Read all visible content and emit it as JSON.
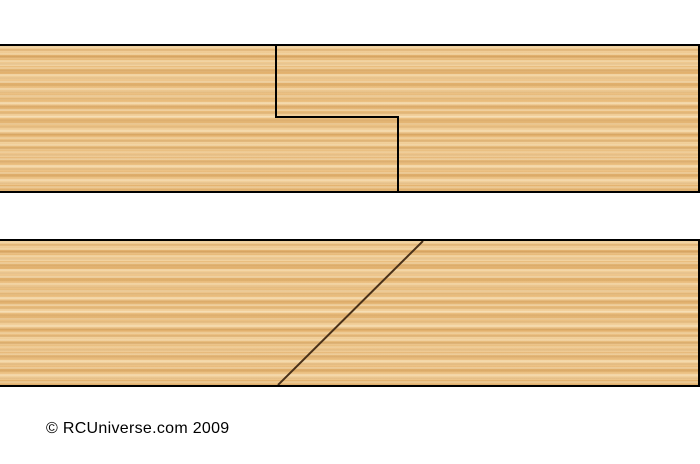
{
  "diagram": {
    "title_visible": false,
    "colors": {
      "background": "#ffffff",
      "wood_base": "#e9bc7e",
      "wood_grain_light": "#f4cd92",
      "wood_grain_dark": "#d9a763",
      "board_outline": "#000000",
      "half_lap_joint_line": "#000000",
      "scarf_joint_line": "#4a3119",
      "copyright_text_color": "#000000"
    }
  },
  "footer": {
    "copyright": "© RCUniverse.com 2009"
  }
}
